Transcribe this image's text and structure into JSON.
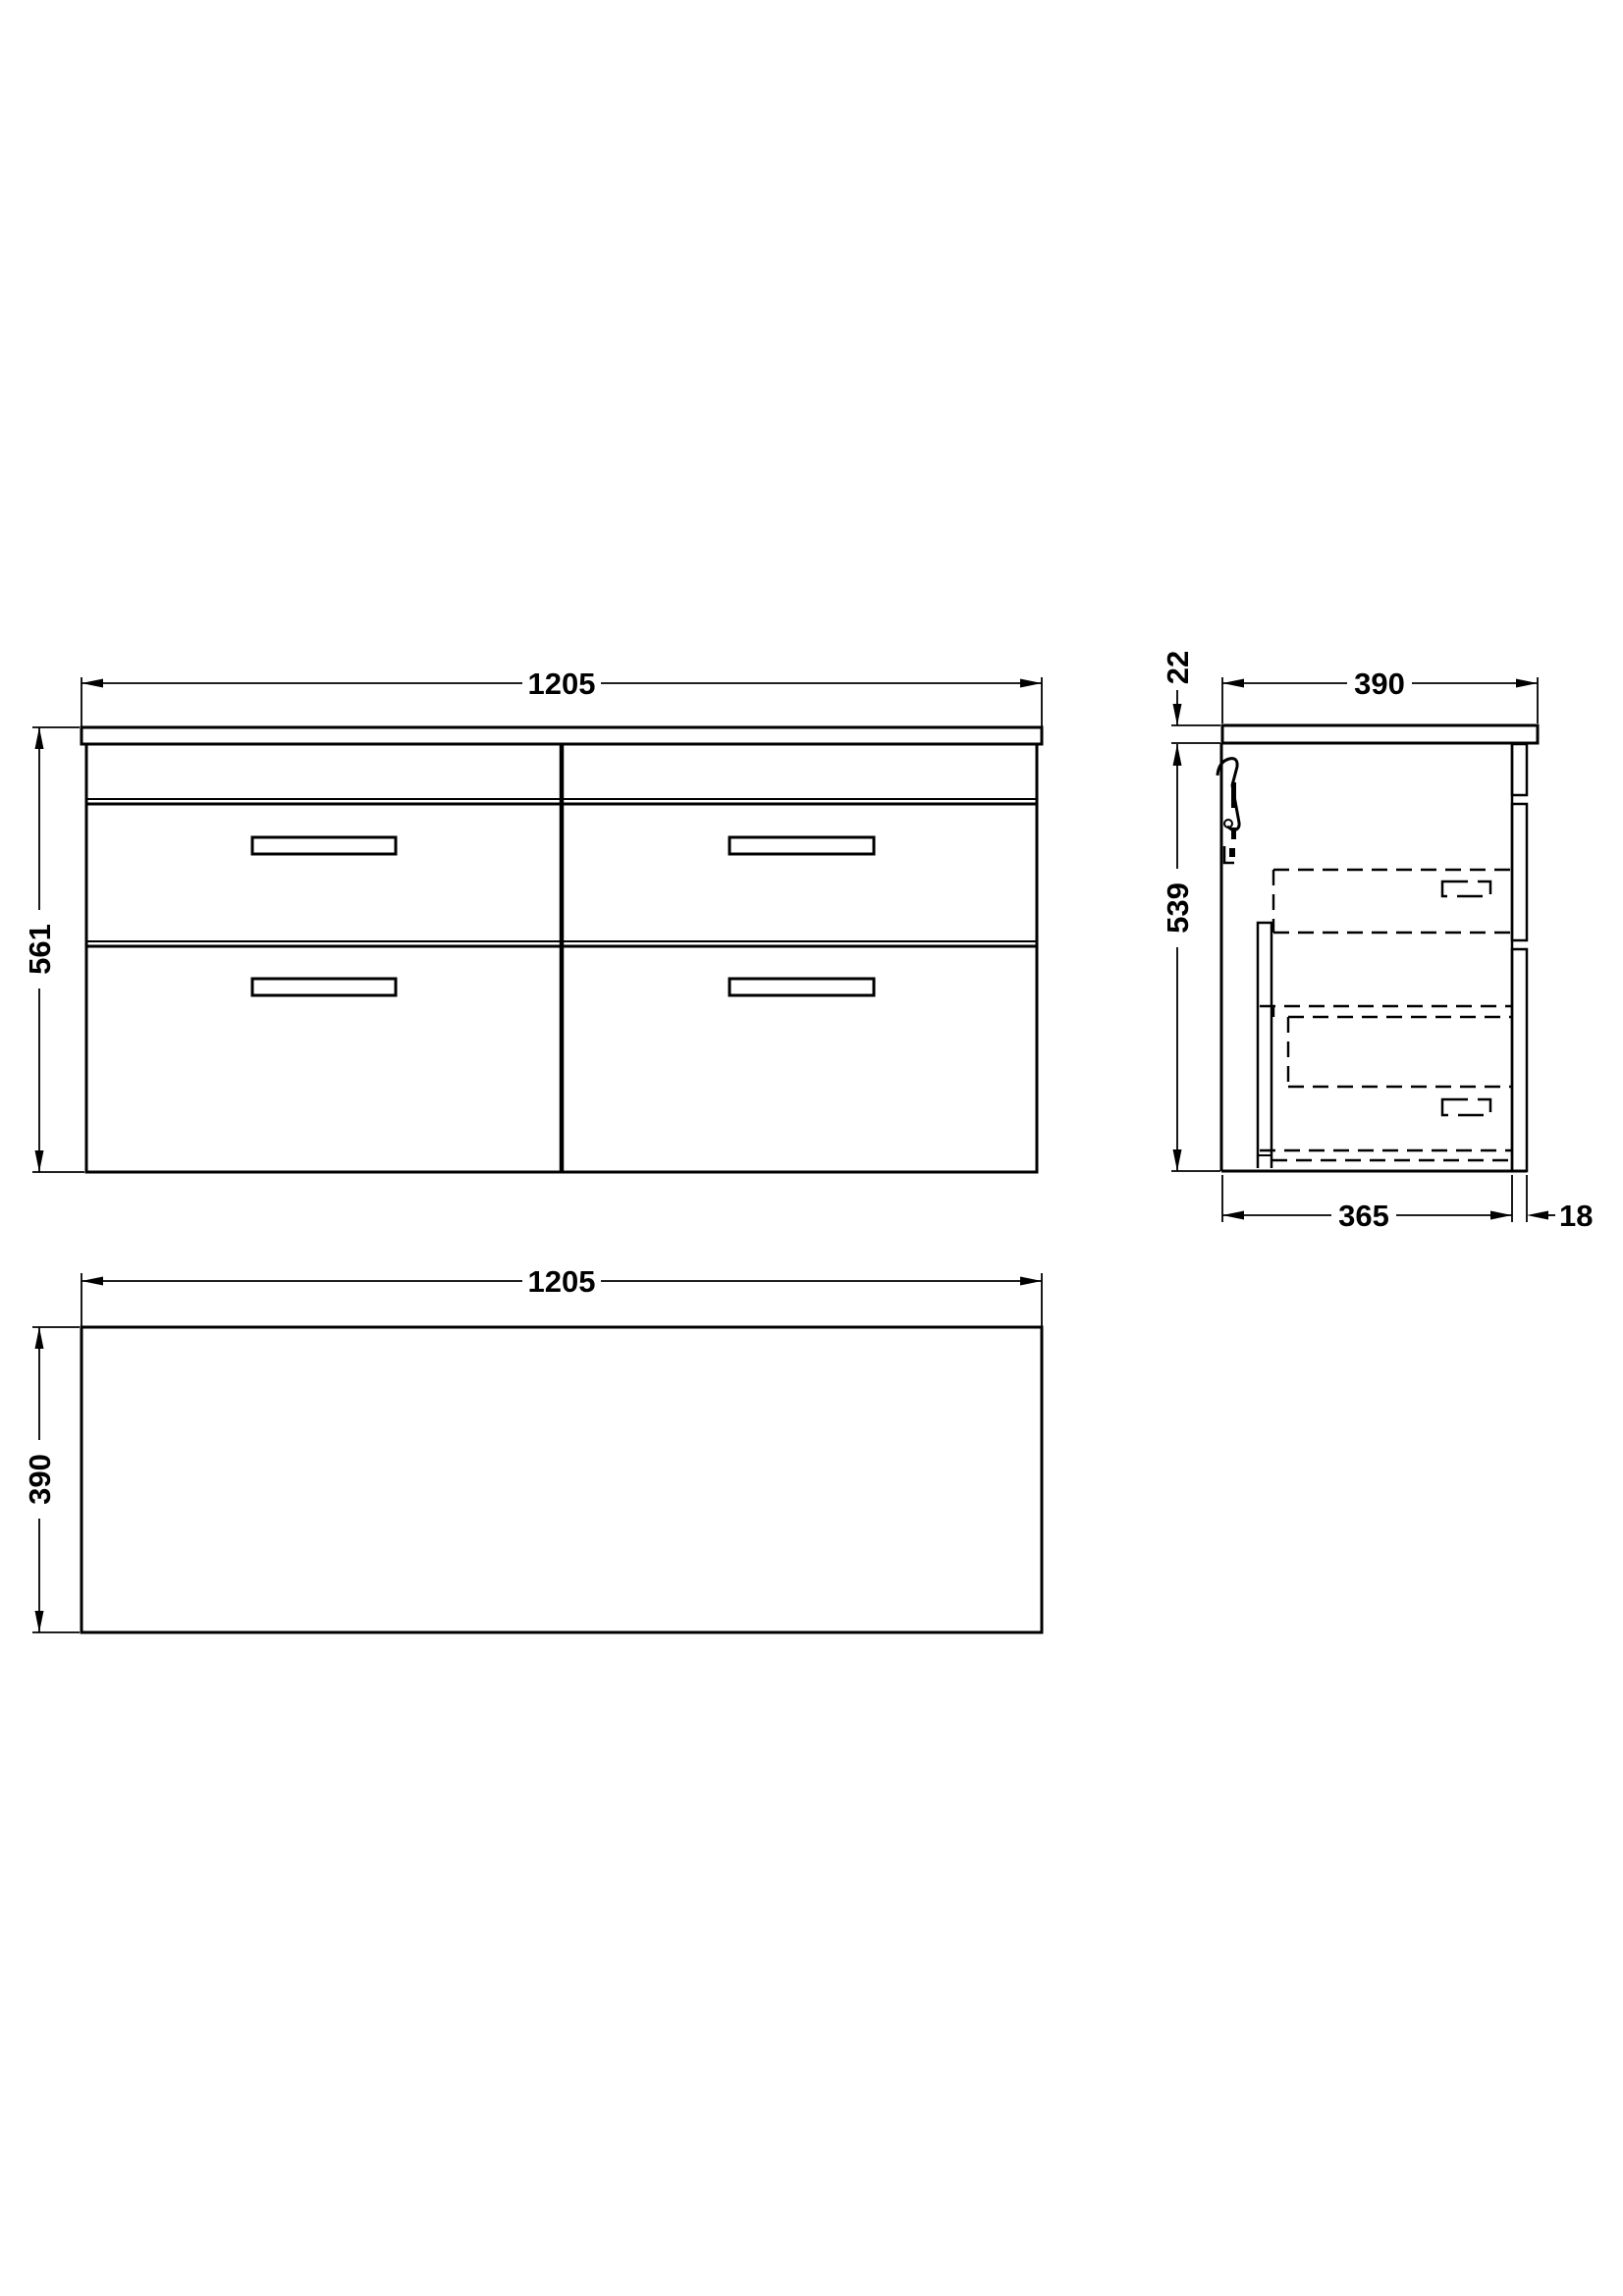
{
  "front_view": {
    "width": "1205",
    "height": "561"
  },
  "side_view": {
    "worktop_thickness": "22",
    "depth": "390",
    "height": "539",
    "carcass_depth": "365",
    "front_panel_thickness": "18"
  },
  "plan_view": {
    "width": "1205",
    "depth": "390"
  },
  "colors": {
    "line": "#000000",
    "background": "#ffffff"
  }
}
